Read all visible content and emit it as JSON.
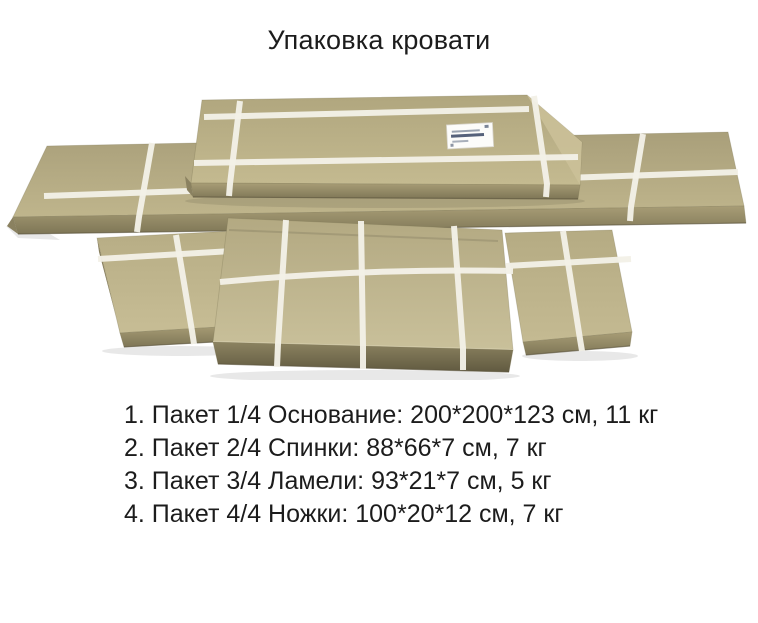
{
  "title": "Упаковка кровати",
  "photo": {
    "description": "Фото четырёх картонных упаковок кровати, перевязанных белыми лентами",
    "box_count": 4
  },
  "packages": {
    "items": [
      "1. Пакет 1/4 Основание: 200*200*123 см, 11 кг",
      "2. Пакет 2/4 Спинки: 88*66*7 см, 7 кг",
      "3. Пакет 3/4 Ламели: 93*21*7 см, 5 кг",
      "4. Пакет 4/4 Ножки: 100*20*12 см, 7 кг"
    ]
  },
  "colors": {
    "bg": "#ffffff",
    "text": "#1c1c1c",
    "cardboard": "#bdb38b",
    "cardboard_front": "#7e7656",
    "strap": "#f2f0e7"
  }
}
